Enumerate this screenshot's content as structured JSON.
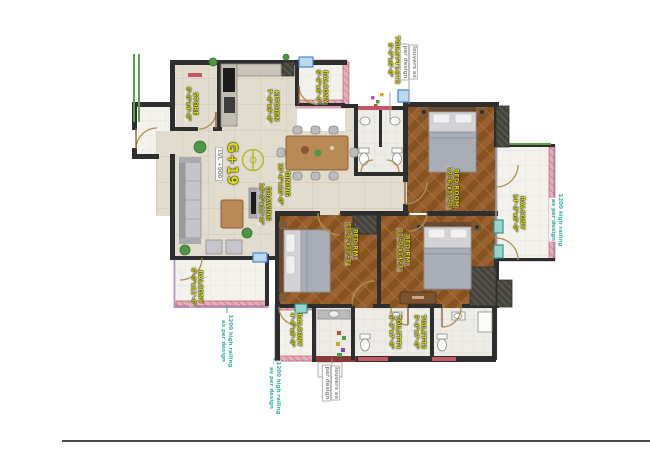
{
  "tower": {
    "label": "G+19",
    "level": "LVL +900"
  },
  "rooms": [
    {
      "key": "store",
      "name": "STORE",
      "dims": "6'-0\"x4'-6\""
    },
    {
      "key": "kitchen",
      "name": "KITCHEN",
      "dims": "7'-6\"x9'-6\""
    },
    {
      "key": "balcony-top",
      "name": "BALCONY",
      "dims": "6'-9\"x6'-0\""
    },
    {
      "key": "toilet-t1-t2",
      "name": "TOILET-T1&T2",
      "dims": "6'-9\"x6'-0\""
    },
    {
      "key": "bedroom-top-right",
      "name": "BED ROOM",
      "dims": "12'-6\"x11'-0\""
    },
    {
      "key": "balcony-right",
      "name": "BALCONY",
      "dims": "14'-3\"x6'-0\""
    },
    {
      "key": "dining",
      "name": "DINING",
      "dims": "10'-6\"x10'-0\""
    },
    {
      "key": "drawing",
      "name": "DRAWING",
      "dims": "16'-0\"x11'-6\""
    },
    {
      "key": "balcony-left",
      "name": "BALCONY",
      "dims": "6'-0\"x11'-6\""
    },
    {
      "key": "bedroom-center",
      "name": "BED RM.",
      "dims": "11'-6\"x12'-3\""
    },
    {
      "key": "bedroom-right",
      "name": "BED RM.",
      "dims": "11'-0\"x14'-3\""
    },
    {
      "key": "balcony-bottom",
      "name": "BALCONY",
      "dims": "4'-6\"x6'-0\""
    },
    {
      "key": "toilet-t4",
      "name": "TOILET-T4",
      "dims": "5'-3\"x7'-0\""
    },
    {
      "key": "toilet-t3",
      "name": "TOILET-T3",
      "dims": "5'-3\"x7'-0\""
    }
  ],
  "notes": {
    "railing": {
      "line1": "1200 high railing",
      "line2": "as per design"
    },
    "louvers": {
      "line1": "louvers as",
      "line2": "per design"
    }
  },
  "colors": {
    "wall": "#2e2e2e",
    "label_yellow": "#dede00",
    "railing_note": "#2fb3a3",
    "louvers_note": "#8f8f8f",
    "parapet_pink": "#e6aeb8",
    "balcony_outline_purple": "#b49cc8",
    "window_blue": "#4a86c8",
    "window_teal": "#2e968c",
    "wood_floor": "#9a6130",
    "tile_floor": "#e2dcce"
  }
}
